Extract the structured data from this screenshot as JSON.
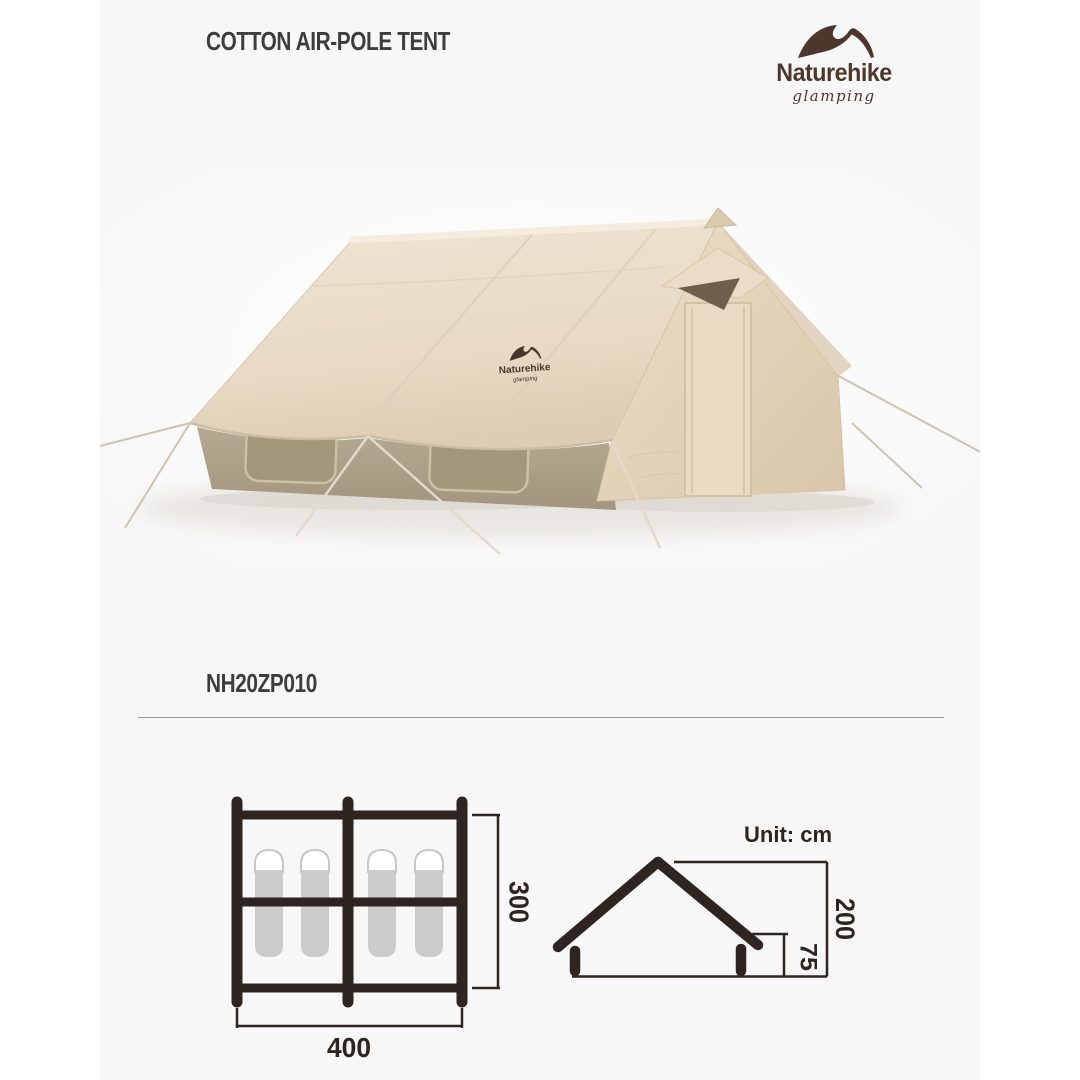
{
  "header": {
    "title": "COTTON AIR-POLE TENT"
  },
  "brand": {
    "name": "Naturehike",
    "tagline": "glamping"
  },
  "product": {
    "model": "NH20ZP010"
  },
  "tent": {
    "roof_logo_name": "Naturehike",
    "roof_logo_tagline": "glamping",
    "canvas_color": "#e9dcc8",
    "wall_color": "#b0a48d"
  },
  "diagrams": {
    "unit_label": "Unit: cm",
    "floor_plan": {
      "width_label": "400",
      "depth_label": "300",
      "sleeping_bag_count": 4
    },
    "elevation": {
      "total_height_label": "200",
      "wall_height_label": "75"
    }
  },
  "colors": {
    "page_background": "#ffffff",
    "panel_background": "#f7f7f7",
    "brand_brown": "#4d362b",
    "diagram_line": "#2e2520",
    "text": "#3d3d3d",
    "divider": "#9a9a9a",
    "sleeping_bag_gray": "#cbcbcb"
  }
}
